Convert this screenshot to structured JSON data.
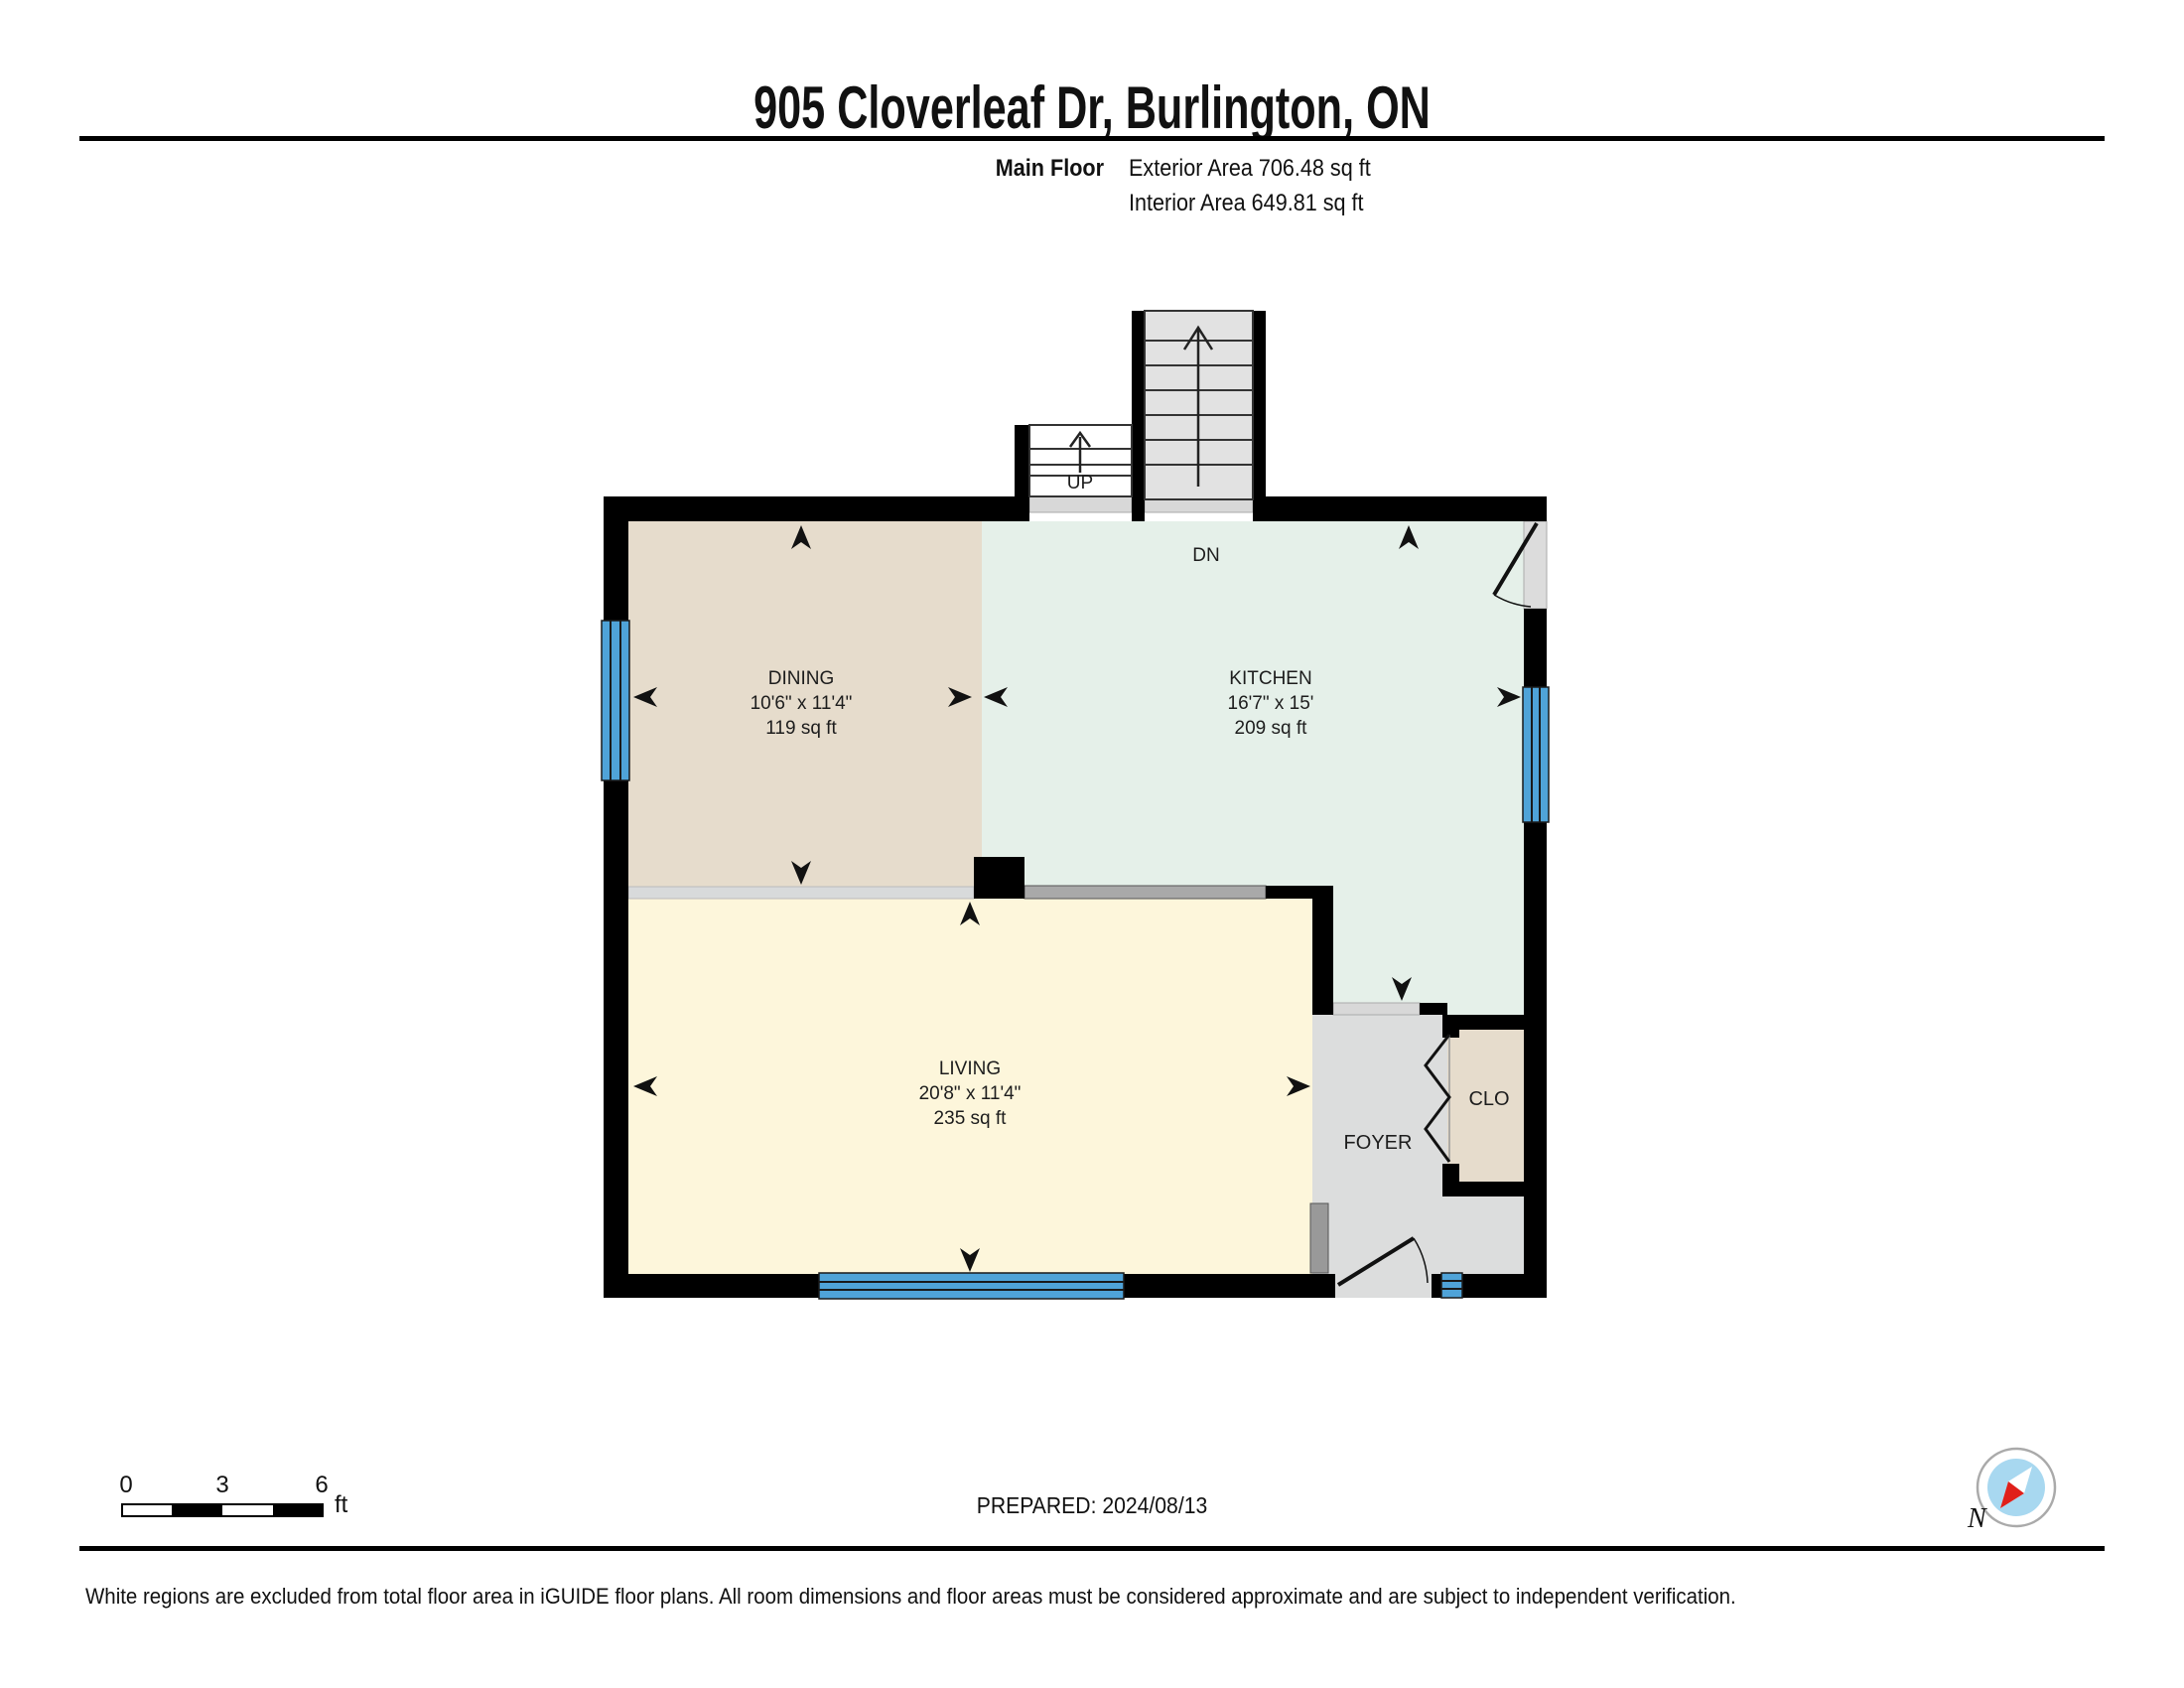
{
  "header": {
    "title": "905 Cloverleaf Dr, Burlington, ON",
    "floor_label": "Main Floor",
    "exterior_area": "Exterior Area 706.48 sq ft",
    "interior_area": "Interior Area 649.81 sq ft"
  },
  "rooms": {
    "dining": {
      "name": "DINING",
      "dims": "10'6\" x 11'4\"",
      "area": "119 sq ft"
    },
    "kitchen": {
      "name": "KITCHEN",
      "dims": "16'7\" x 15'",
      "area": "209 sq ft"
    },
    "living": {
      "name": "LIVING",
      "dims": "20'8\" x 11'4\"",
      "area": "235 sq ft"
    },
    "foyer": {
      "name": "FOYER"
    },
    "closet": {
      "name": "CLO"
    }
  },
  "stairs": {
    "up_label": "UP",
    "down_label": "DN"
  },
  "scale_bar": {
    "tick_0": "0",
    "tick_3": "3",
    "tick_6": "6",
    "unit": "ft"
  },
  "footer": {
    "prepared": "PREPARED: 2024/08/13",
    "disclaimer": "White regions are excluded from total floor area in iGUIDE floor plans. All room dimensions and floor areas must be considered approximate and are subject to independent verification.",
    "compass_label": "N"
  },
  "colors": {
    "wall": "#000000",
    "dining_floor": "#e6dccc",
    "kitchen_floor": "#e5f0e9",
    "living_floor": "#fdf6db",
    "foyer_floor": "#dcdddd",
    "closet_floor": "#e6dccc",
    "stair_fill": "#e2e2e2",
    "threshold": "#d8d8d8",
    "counter": "#a9a9a9",
    "window_blue": "#4fa3d8",
    "compass_blue": "#a8d8f0",
    "compass_red": "#e0201a"
  }
}
